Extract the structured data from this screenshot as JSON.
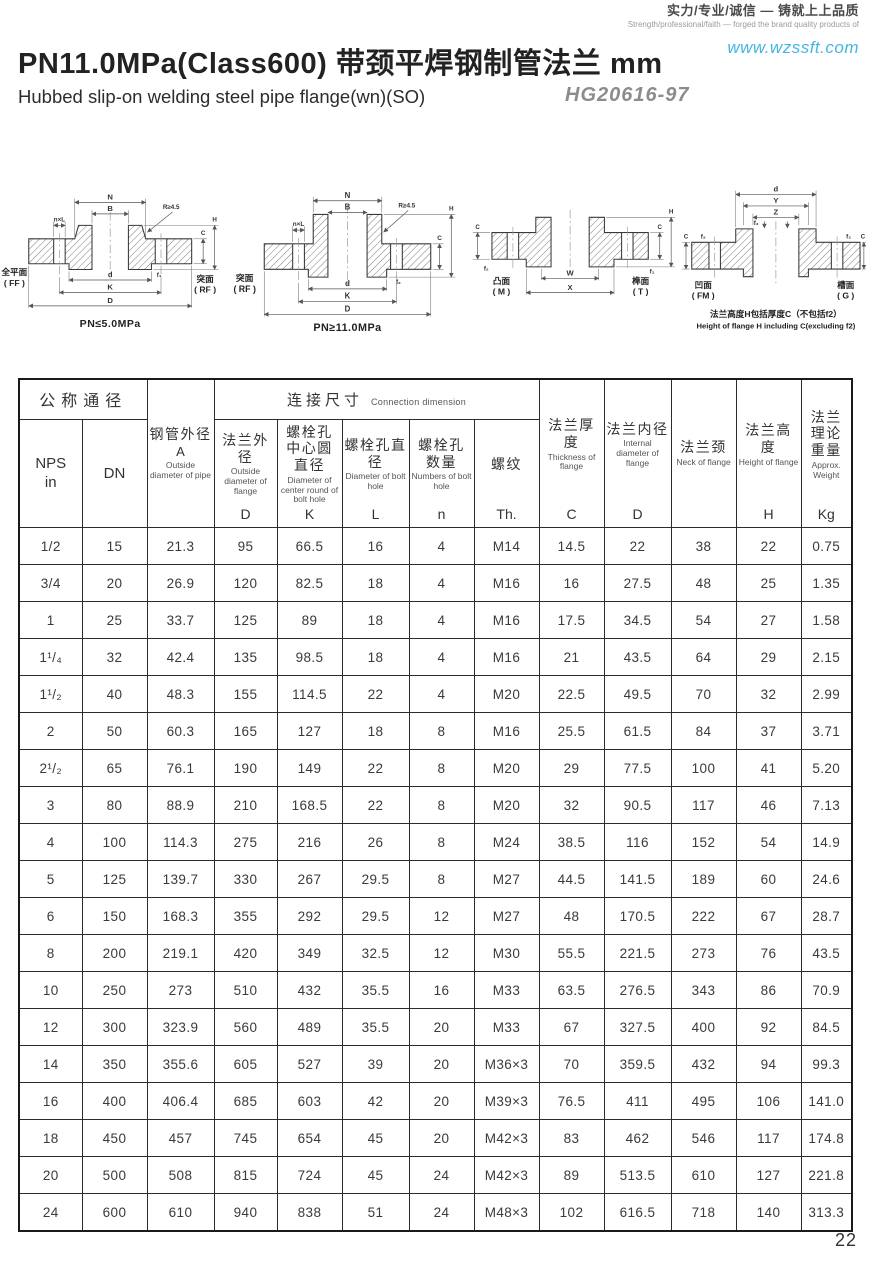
{
  "brand": {
    "slogan_cn": "实力/专业/诚信 — 铸就上上品质",
    "slogan_en": "Strength/professional/faith — forged the brand quality products of",
    "website": "www.wzssft.com"
  },
  "header": {
    "title": "PN11.0MPa(Class600) 带颈平焊钢制管法兰  mm",
    "subtitle": "Hubbed slip-on welding steel pipe flange(wn)(SO)",
    "standard": "HG20616-97"
  },
  "diagrams": [
    {
      "caption": "PN≤5.0MPa",
      "face_left_1": "全平面",
      "face_left_2": "( FF )",
      "face_right_1": "突面",
      "face_right_2": "( RF )",
      "dim_n": "N",
      "dim_b": "B",
      "dim_r": "R≥4.5",
      "dim_nxl": "n×L",
      "dim_d_small": "d",
      "dim_k": "K",
      "dim_d": "D",
      "dim_c": "C",
      "dim_h": "H",
      "dim_f": "f₁"
    },
    {
      "caption": "PN≥11.0MPa",
      "face_left_1": "突面",
      "face_left_2": "( RF )",
      "dim_n": "N",
      "dim_b": "B",
      "dim_r": "R≥4.5",
      "dim_nxl": "n×L",
      "dim_d_small": "d",
      "dim_k": "K",
      "dim_d": "D",
      "dim_c": "C",
      "dim_h": "H",
      "dim_f": "f₂"
    },
    {
      "face_left_1": "凸面",
      "face_left_2": "( M )",
      "face_right_1": "榫面",
      "face_right_2": "( T )",
      "dim_w": "W",
      "dim_x": "X",
      "dim_c": "C",
      "dim_h": "H",
      "dim_f": "f₂"
    },
    {
      "face_left_1": "凹面",
      "face_left_2": "( FM )",
      "face_right_1": "槽面",
      "face_right_2": "( G )",
      "dim_d": "d",
      "dim_y": "Y",
      "dim_z": "Z",
      "dim_c": "C",
      "dim_f2": "f₂",
      "dim_f3": "f₃",
      "note_1": "法兰高度H包括厚度C（不包括f2）",
      "note_2": "Height of flange H including C(excluding f2)"
    }
  ],
  "table": {
    "group_nominal": "公称通径",
    "group_connection_cn": "连接尺寸",
    "group_connection_en": "Connection dimension",
    "cols": {
      "nps": {
        "l1": "NPS",
        "l2": "in"
      },
      "dn": "DN",
      "pipe_od": {
        "cn": "钢管外径",
        "sym": "A",
        "en": "Outside diameter of pipe"
      },
      "flange_od": {
        "cn": "法兰外径",
        "en": "Outside diameter of flange",
        "sym": "D"
      },
      "bolt_circle": {
        "cn": "螺栓孔中心圆直径",
        "en": "Diameter of center round of bolt hole",
        "sym": "K"
      },
      "bolt_hole": {
        "cn": "螺栓孔直径",
        "en": "Diameter of bolt hole",
        "sym": "L"
      },
      "bolt_num": {
        "cn": "螺栓孔数量",
        "en": "Numbers of bolt hole",
        "sym": "n"
      },
      "thread": {
        "cn": "螺纹",
        "sym": "Th."
      },
      "thickness": {
        "cn": "法兰厚度",
        "en": "Thickness of flange",
        "sym": "C"
      },
      "flange_id": {
        "cn": "法兰内径",
        "en": "Internal diameter of flange",
        "sym": "D"
      },
      "neck": {
        "cn": "法兰颈",
        "en": "Neck of flange"
      },
      "height": {
        "cn": "法兰高度",
        "en": "Height of flange",
        "sym": "H"
      },
      "weight": {
        "cn": "法兰理论重量",
        "en": "Approx. Weight",
        "sym": "Kg"
      }
    },
    "rows": [
      [
        "1/2",
        "15",
        "21.3",
        "95",
        "66.5",
        "16",
        "4",
        "M14",
        "14.5",
        "22",
        "38",
        "22",
        "0.75"
      ],
      [
        "3/4",
        "20",
        "26.9",
        "120",
        "82.5",
        "18",
        "4",
        "M16",
        "16",
        "27.5",
        "48",
        "25",
        "1.35"
      ],
      [
        "1",
        "25",
        "33.7",
        "125",
        "89",
        "18",
        "4",
        "M16",
        "17.5",
        "34.5",
        "54",
        "27",
        "1.58"
      ],
      [
        "1¹/₄",
        "32",
        "42.4",
        "135",
        "98.5",
        "18",
        "4",
        "M16",
        "21",
        "43.5",
        "64",
        "29",
        "2.15"
      ],
      [
        "1¹/₂",
        "40",
        "48.3",
        "155",
        "114.5",
        "22",
        "4",
        "M20",
        "22.5",
        "49.5",
        "70",
        "32",
        "2.99"
      ],
      [
        "2",
        "50",
        "60.3",
        "165",
        "127",
        "18",
        "8",
        "M16",
        "25.5",
        "61.5",
        "84",
        "37",
        "3.71"
      ],
      [
        "2¹/₂",
        "65",
        "76.1",
        "190",
        "149",
        "22",
        "8",
        "M20",
        "29",
        "77.5",
        "100",
        "41",
        "5.20"
      ],
      [
        "3",
        "80",
        "88.9",
        "210",
        "168.5",
        "22",
        "8",
        "M20",
        "32",
        "90.5",
        "117",
        "46",
        "7.13"
      ],
      [
        "4",
        "100",
        "114.3",
        "275",
        "216",
        "26",
        "8",
        "M24",
        "38.5",
        "116",
        "152",
        "54",
        "14.9"
      ],
      [
        "5",
        "125",
        "139.7",
        "330",
        "267",
        "29.5",
        "8",
        "M27",
        "44.5",
        "141.5",
        "189",
        "60",
        "24.6"
      ],
      [
        "6",
        "150",
        "168.3",
        "355",
        "292",
        "29.5",
        "12",
        "M27",
        "48",
        "170.5",
        "222",
        "67",
        "28.7"
      ],
      [
        "8",
        "200",
        "219.1",
        "420",
        "349",
        "32.5",
        "12",
        "M30",
        "55.5",
        "221.5",
        "273",
        "76",
        "43.5"
      ],
      [
        "10",
        "250",
        "273",
        "510",
        "432",
        "35.5",
        "16",
        "M33",
        "63.5",
        "276.5",
        "343",
        "86",
        "70.9"
      ],
      [
        "12",
        "300",
        "323.9",
        "560",
        "489",
        "35.5",
        "20",
        "M33",
        "67",
        "327.5",
        "400",
        "92",
        "84.5"
      ],
      [
        "14",
        "350",
        "355.6",
        "605",
        "527",
        "39",
        "20",
        "M36×3",
        "70",
        "359.5",
        "432",
        "94",
        "99.3"
      ],
      [
        "16",
        "400",
        "406.4",
        "685",
        "603",
        "42",
        "20",
        "M39×3",
        "76.5",
        "411",
        "495",
        "106",
        "141.0"
      ],
      [
        "18",
        "450",
        "457",
        "745",
        "654",
        "45",
        "20",
        "M42×3",
        "83",
        "462",
        "546",
        "117",
        "174.8"
      ],
      [
        "20",
        "500",
        "508",
        "815",
        "724",
        "45",
        "24",
        "M42×3",
        "89",
        "513.5",
        "610",
        "127",
        "221.8"
      ],
      [
        "24",
        "600",
        "610",
        "940",
        "838",
        "51",
        "24",
        "M48×3",
        "102",
        "616.5",
        "718",
        "140",
        "313.3"
      ]
    ]
  },
  "page_number": "22"
}
